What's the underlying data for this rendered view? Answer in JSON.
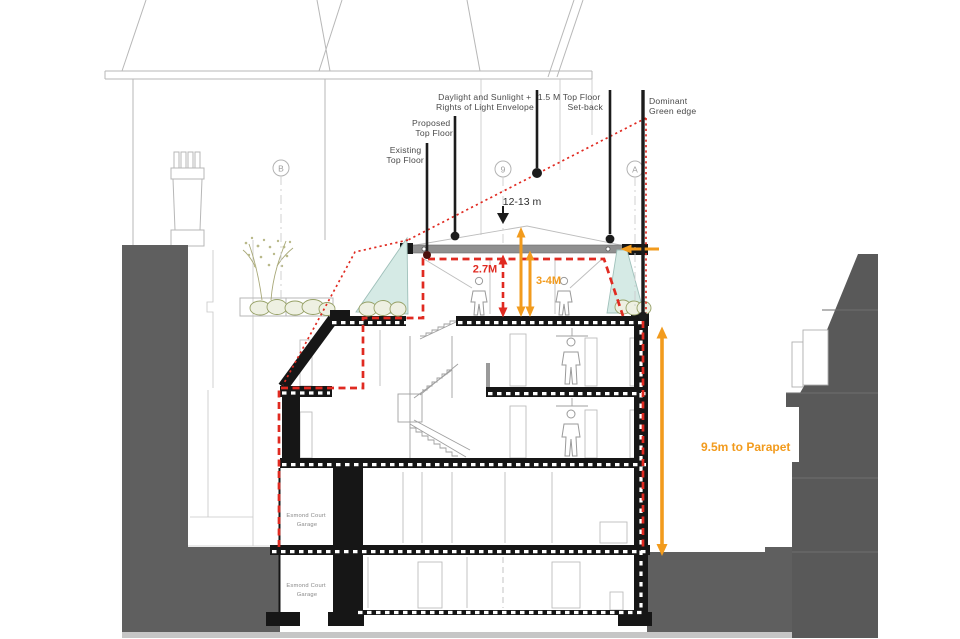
{
  "annotations": {
    "existing_top_floor": {
      "line1": "Existing",
      "line2": "Top Floor"
    },
    "proposed_top_floor": {
      "line1": "Proposed",
      "line2": "Top Floor"
    },
    "daylight_envelope": {
      "line1": "Daylight and Sunlight +",
      "line2": "Rights of Light Envelope"
    },
    "top_floor_setback": {
      "line1": "1.5 M Top Floor",
      "line2": "Set-back"
    },
    "dominant_green_edge": {
      "line1": "Dominant",
      "line2": "Green edge"
    }
  },
  "dimensions": {
    "building_span": "12-13 m",
    "proposed_height": "2.7M",
    "envelope_height": "3-4M",
    "parapet_height": "9.5m to Parapet"
  },
  "grid_markers": {
    "b": "B",
    "nine": "9",
    "a": "A"
  },
  "rooms": {
    "garage_upper": {
      "line1": "Esmond Court",
      "line2": "Garage"
    },
    "garage_lower": {
      "line1": "Esmond Court",
      "line2": "Garage"
    }
  },
  "colors": {
    "annotation_red": "#e02a21",
    "annotation_orange": "#f29b1d",
    "glazing_teal": "#d5eae5",
    "planting_olive": "#96a066",
    "ground_gray": "#5f5f5f",
    "neighbor_building_gray": "#595959",
    "section_black": "#161616",
    "sketch_line_gray": "#b4b4b4",
    "roof_slab_gray": "#8f8f8f"
  }
}
